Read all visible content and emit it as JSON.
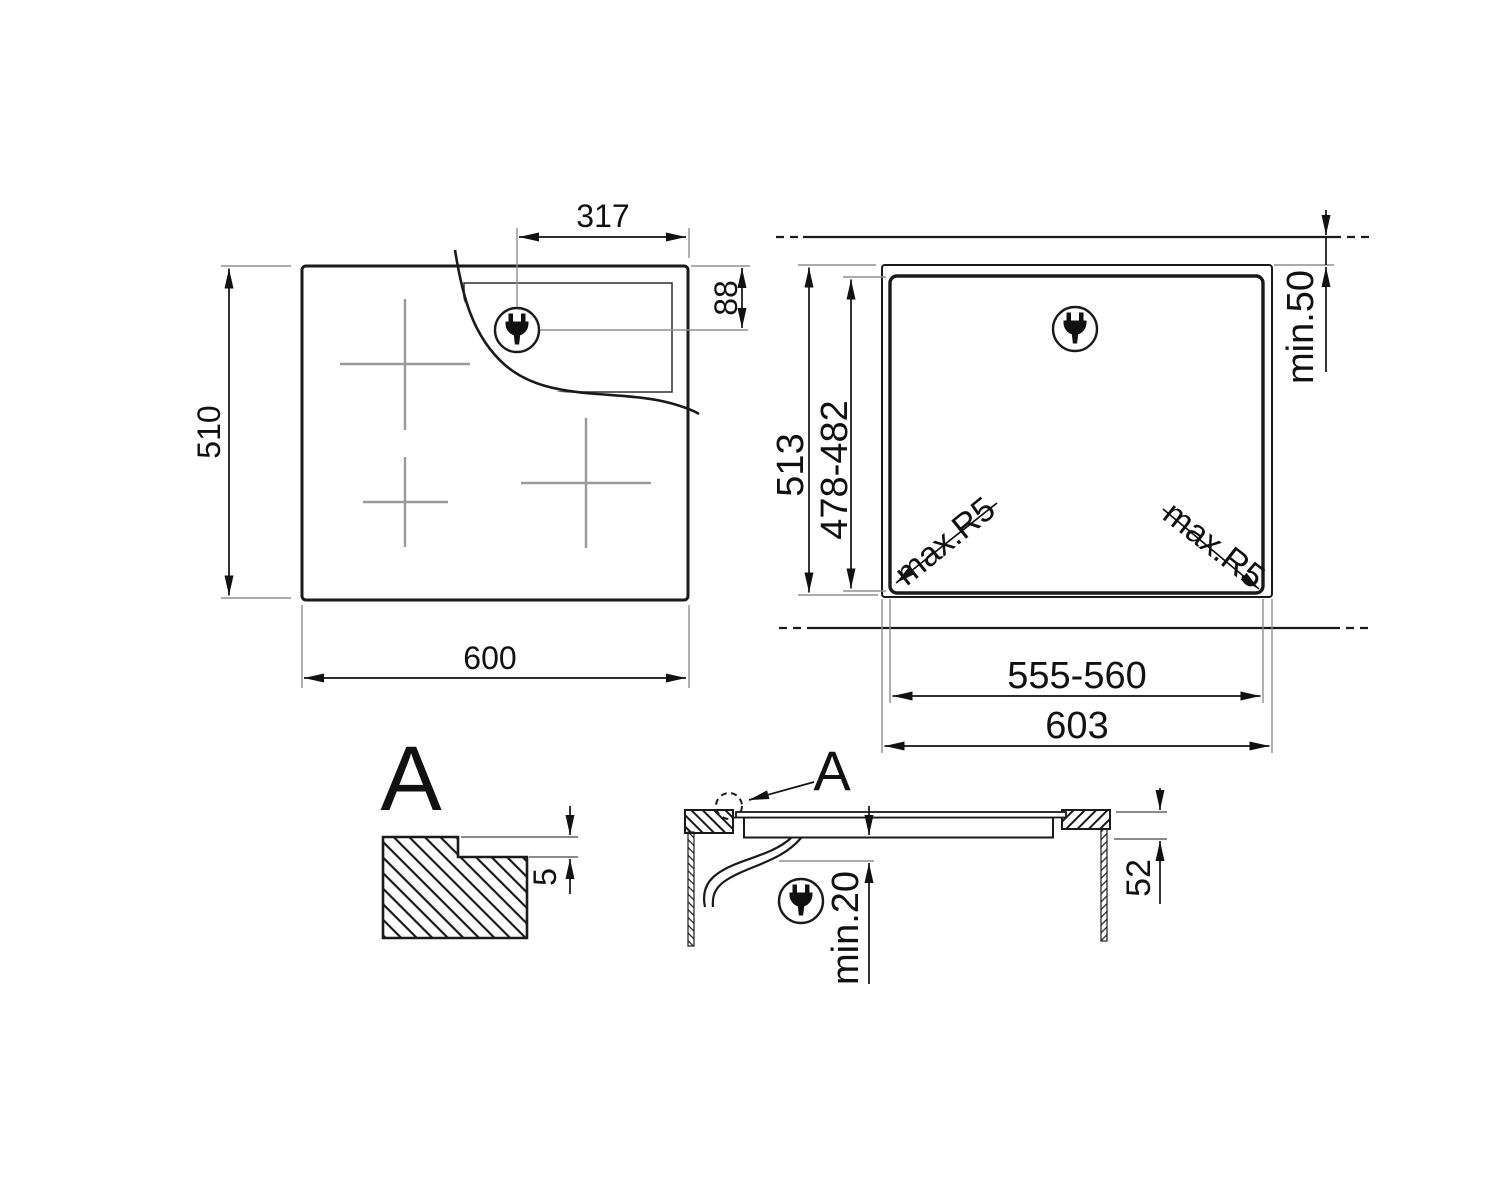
{
  "colors": {
    "line": "#1a1a1a",
    "dimension": "#111111",
    "auxiliary": "#8f8f8f",
    "zone_cross": "#9a9a9a",
    "background": "#ffffff"
  },
  "top_view": {
    "overall_width": "600",
    "overall_depth": "510",
    "plug_offset_x": "317",
    "plug_offset_y": "88"
  },
  "cutout_view": {
    "outer_depth": "513",
    "cutout_depth": "478-482",
    "wall_clearance": "min.50",
    "corner_radius_left": "max.R5",
    "corner_radius_right": "max.R5",
    "cutout_width": "555-560",
    "outer_width": "603"
  },
  "detail_view": {
    "label": "A",
    "step_depth": "5"
  },
  "section_view": {
    "callout_label": "A",
    "clearance_below": "min.20",
    "built_in_depth": "52"
  },
  "icons": {
    "plug": "power-plug-icon"
  }
}
